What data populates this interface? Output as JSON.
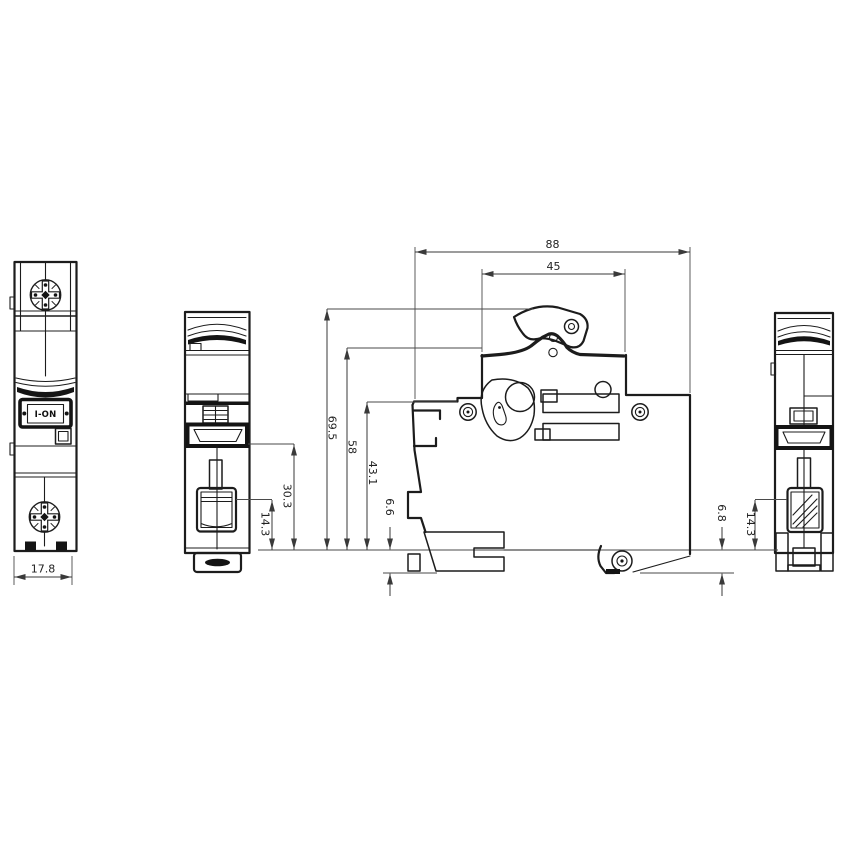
{
  "drawing": {
    "title": "Miniature circuit breaker (1-pole) outline and mounting dimension drawing",
    "units": "mm",
    "colors": {
      "line": "#1c1c1c",
      "dimension": "#3a3a3a",
      "background": "#ffffff"
    },
    "front_view": {
      "toggle_label": "I-ON",
      "unit_width": "17.8"
    },
    "side_view": {
      "overall_depth": "88",
      "upper_depth": "45",
      "overall_height": "69.5",
      "case_height": "58",
      "step_height": "43.1",
      "front_clip_protrusion": "6.6",
      "rear_clip_protrusion": "6.8"
    },
    "edge_views": {
      "terminal_height": "30.3",
      "screw_height": "14.3",
      "screw_height_right": "14.3"
    }
  }
}
